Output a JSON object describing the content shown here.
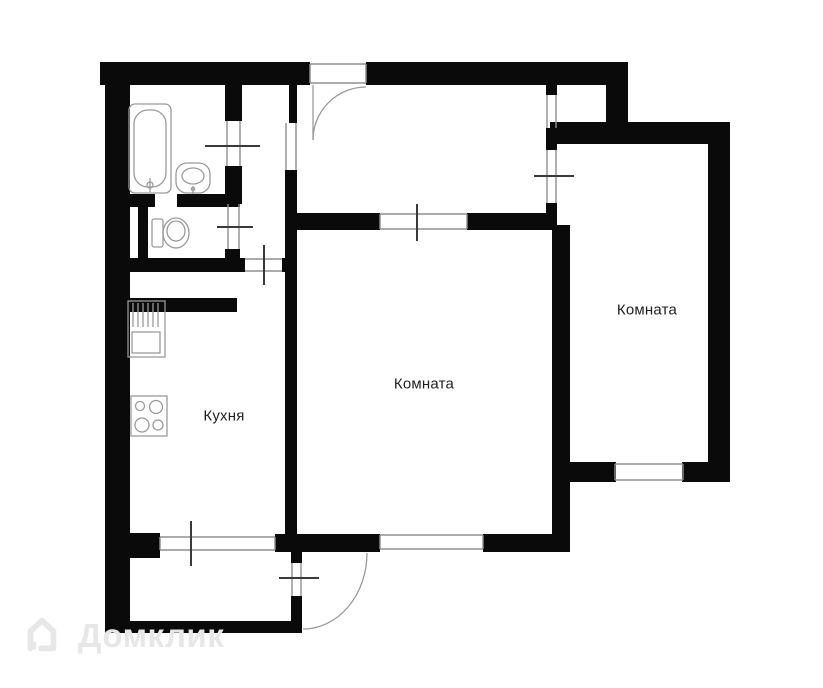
{
  "plan": {
    "rooms": [
      {
        "id": "kitchen",
        "label": "Кухня"
      },
      {
        "id": "room-main",
        "label": "Комната"
      },
      {
        "id": "room-right",
        "label": "Комната"
      }
    ],
    "fixtures": [
      "bathtub-icon",
      "wash-sink-icon",
      "toilet-icon",
      "kitchen-sink-icon",
      "stove-icon"
    ],
    "colors": {
      "wall": "#0a0a0a",
      "thin_line": "#8f8f8f",
      "arc_line": "#9a9a9a",
      "tick": "#3a3a3a",
      "fixture_line": "#9a9a9a",
      "watermark": "#e7e7e7",
      "background": "#ffffff"
    }
  },
  "watermark": {
    "brand": "Домклик",
    "icon": "house-icon"
  }
}
